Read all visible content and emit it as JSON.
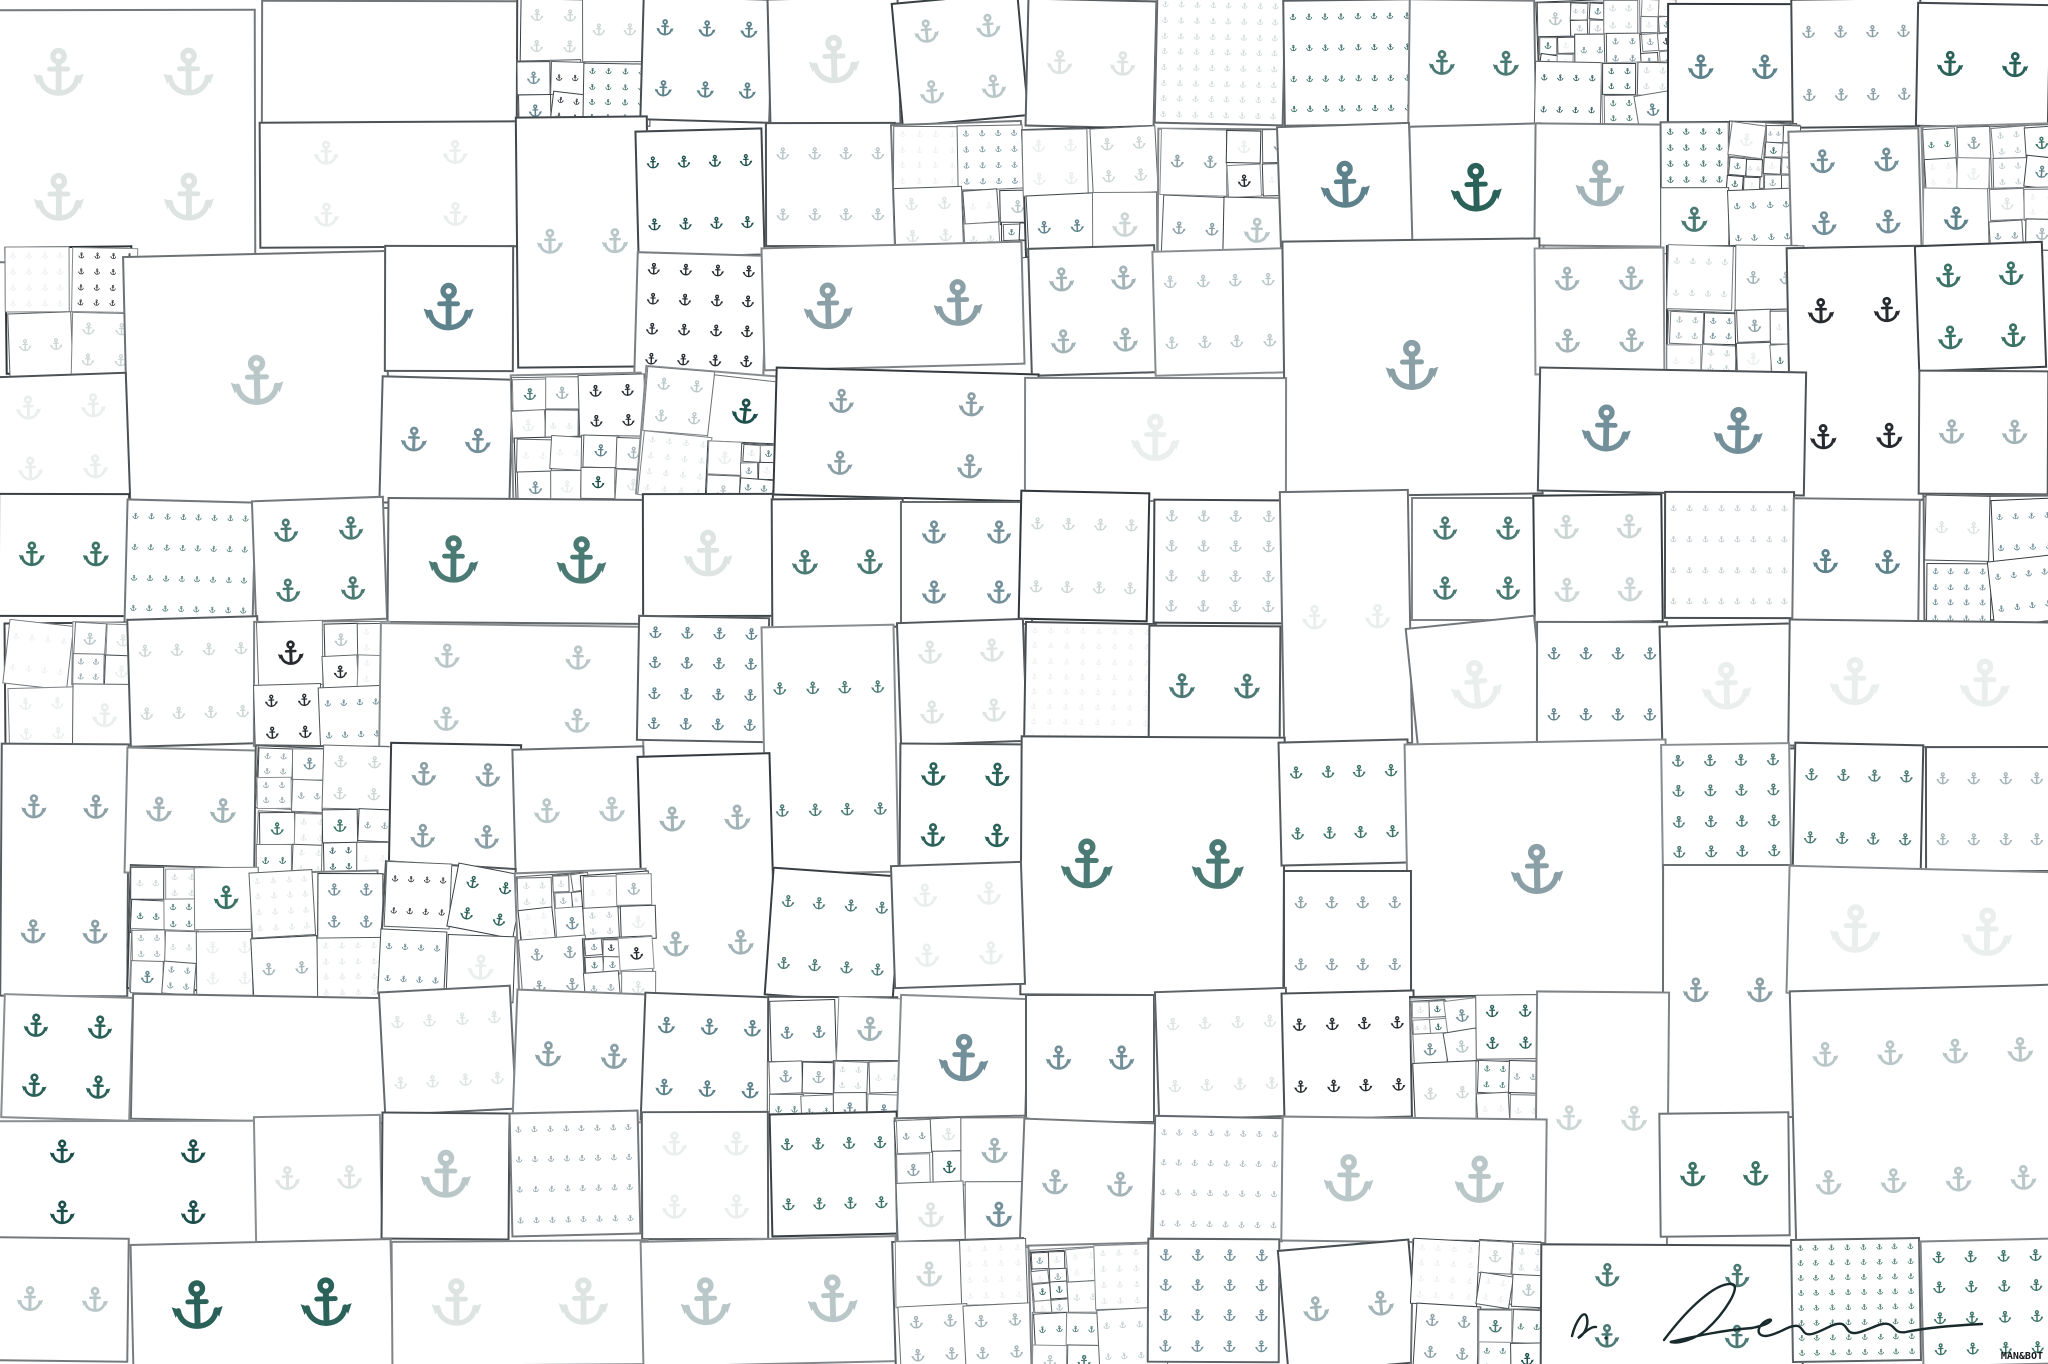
{
  "canvas": {
    "width": 2048,
    "height": 1364,
    "background": "#ffffff"
  },
  "watermark": {
    "label": "MAN&BOT",
    "color": "#14181b"
  },
  "signature": {
    "color": "#182a2b"
  },
  "mosaic": {
    "cols": 16,
    "rows": 11,
    "seed": 7,
    "tile_fill": "#ffffff",
    "border_color_rgb": "45,52,56",
    "palette": [
      "#eaeeec",
      "#dde4e2",
      "#ccd6d4",
      "#bac7c8",
      "#a3b4b8",
      "#8ba0a6",
      "#73909a",
      "#5d828b",
      "#4b7a75",
      "#3a7265",
      "#2a6159",
      "#1d4f4c",
      "#272b30"
    ]
  }
}
